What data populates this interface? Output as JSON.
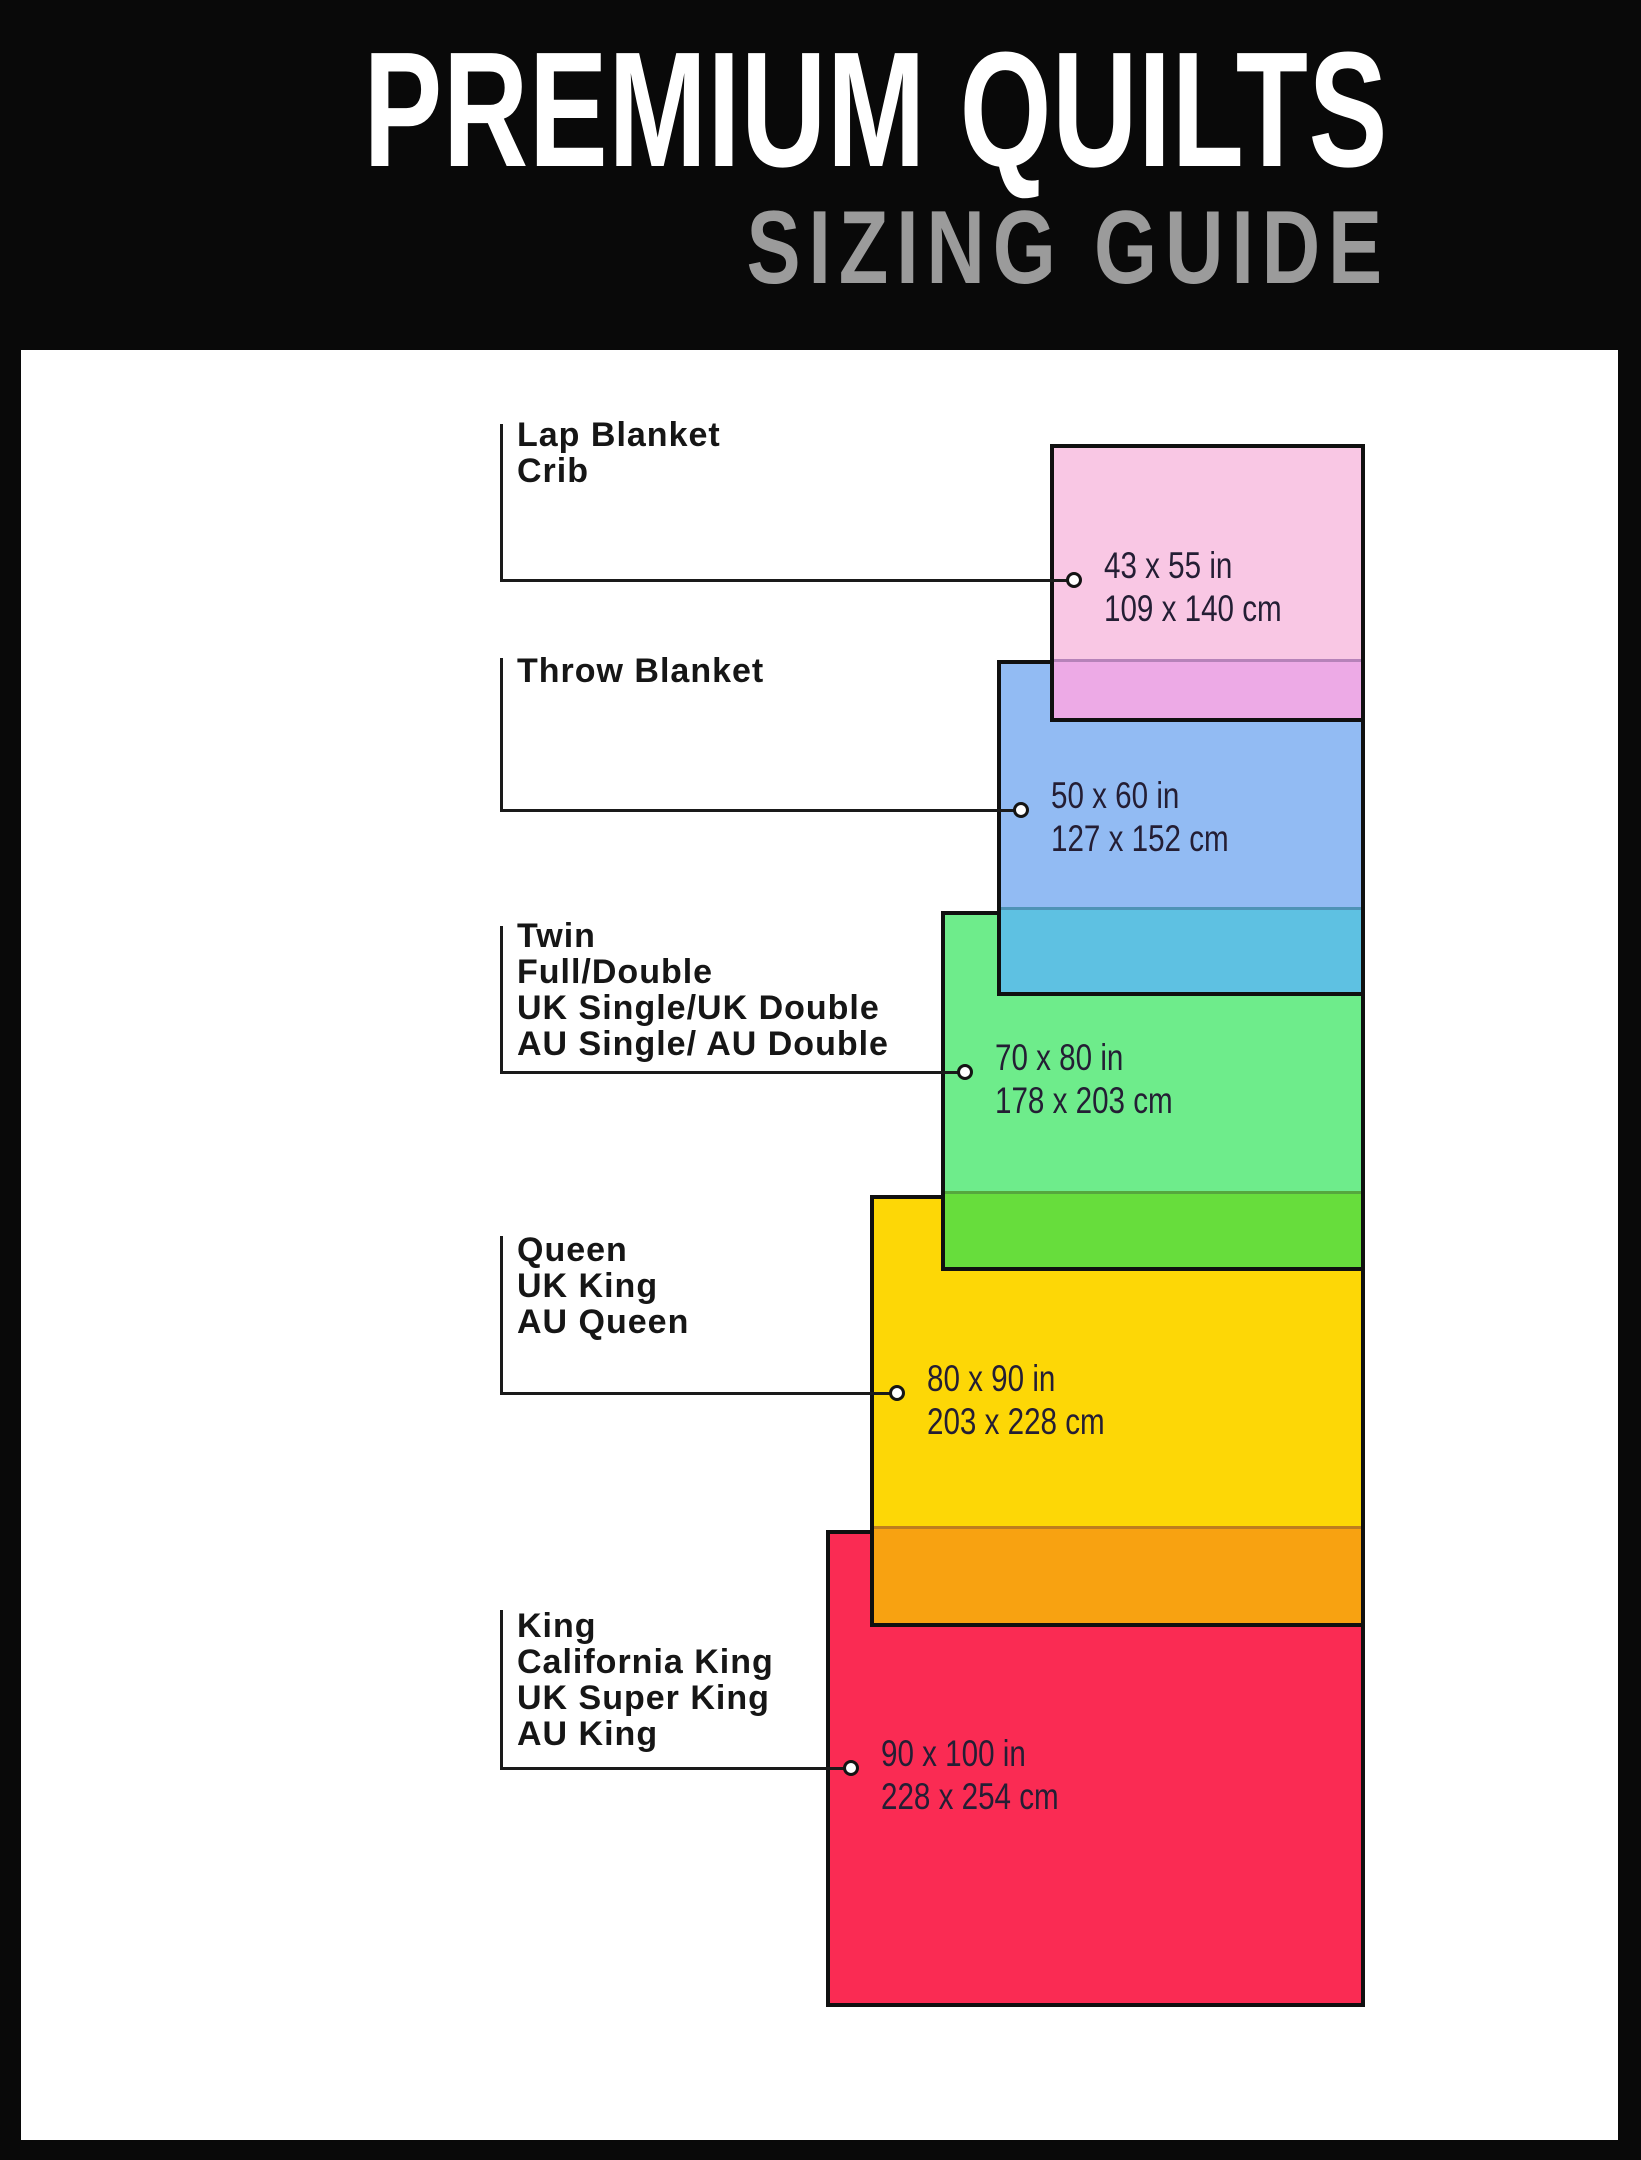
{
  "header": {
    "title": "PREMIUM QUILTS",
    "subtitle": "SIZING GUIDE",
    "bg_color": "#090909",
    "title_color": "#ffffff",
    "subtitle_color": "#9b9b9b"
  },
  "guide": {
    "items": [
      {
        "id": "lap-crib",
        "labels": [
          "Lap Blanket",
          "Crib"
        ],
        "inches": "43 x 55 in",
        "cm": "109 x 140 cm",
        "fill": "#f9c7e4",
        "overlap_fill": "#edaae6"
      },
      {
        "id": "throw",
        "labels": [
          "Throw Blanket"
        ],
        "inches": "50 x 60 in",
        "cm": "127 x 152 cm",
        "fill": "#92bbf3",
        "overlap_fill": "#5ec1e2"
      },
      {
        "id": "twin-full-double",
        "labels": [
          "Twin",
          "Full/Double",
          "UK Single/UK Double",
          "AU Single/ AU Double"
        ],
        "inches": "70 x 80 in",
        "cm": "178 x 203 cm",
        "fill": "#6eec8b",
        "overlap_fill": "#67dd3c"
      },
      {
        "id": "queen",
        "labels": [
          "Queen",
          "UK King",
          "AU Queen"
        ],
        "inches": "80 x 90 in",
        "cm": "203 x 228 cm",
        "fill": "#fdd706",
        "overlap_fill": "#f8a211"
      },
      {
        "id": "king",
        "labels": [
          "King",
          "California King",
          "UK Super King",
          "AU King"
        ],
        "inches": "90 x 100 in",
        "cm": "228 x 254 cm",
        "fill": "#fa2b53",
        "overlap_fill": null
      }
    ]
  }
}
